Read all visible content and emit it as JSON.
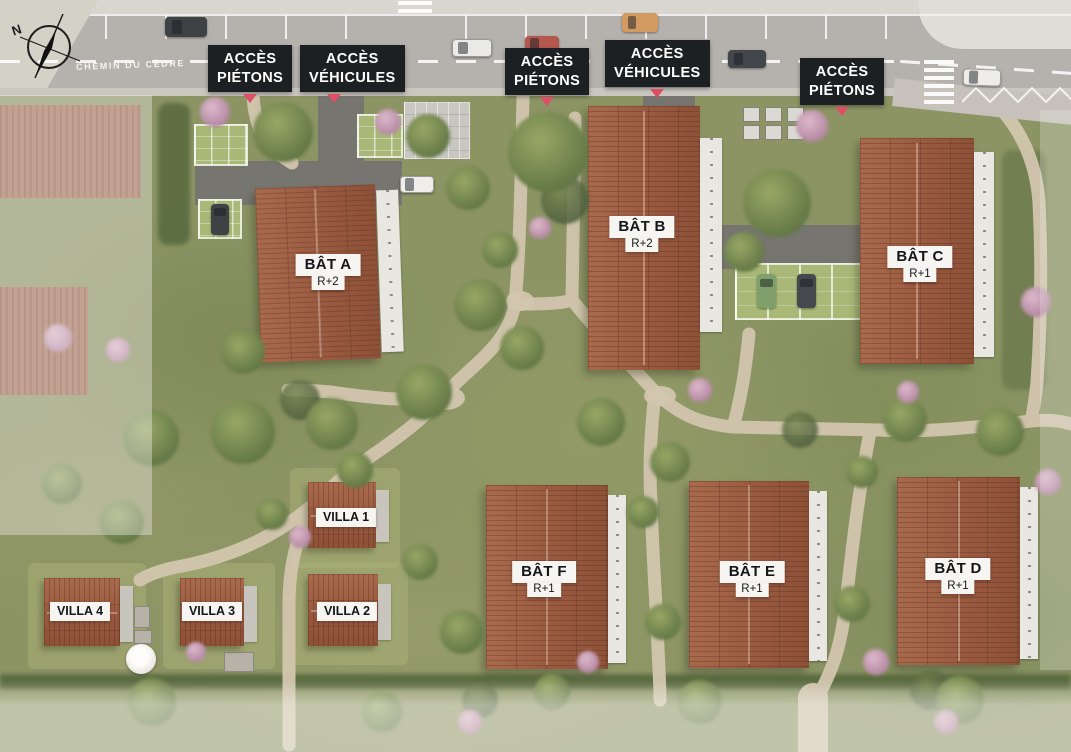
{
  "compass": {
    "label": "N"
  },
  "street": {
    "name": "CHEMIN DU CÈDRE"
  },
  "access_points": [
    {
      "line1": "ACCÈS",
      "line2": "PIÉTONS"
    },
    {
      "line1": "ACCÈS",
      "line2": "VÉHICULES"
    },
    {
      "line1": "ACCÈS",
      "line2": "PIÉTONS"
    },
    {
      "line1": "ACCÈS",
      "line2": "VÉHICULES"
    },
    {
      "line1": "ACCÈS",
      "line2": "PIÉTONS"
    }
  ],
  "buildings": [
    {
      "name": "BÂT A",
      "floors": "R+2"
    },
    {
      "name": "BÂT B",
      "floors": "R+2"
    },
    {
      "name": "BÂT C",
      "floors": "R+1"
    },
    {
      "name": "BÂT F",
      "floors": "R+1"
    },
    {
      "name": "BÂT E",
      "floors": "R+1"
    },
    {
      "name": "BÂT D",
      "floors": "R+1"
    }
  ],
  "villas": [
    {
      "name": "VILLA 1"
    },
    {
      "name": "VILLA 2"
    },
    {
      "name": "VILLA 3"
    },
    {
      "name": "VILLA 4"
    }
  ],
  "colors": {
    "access_label_bg": "#1d2023",
    "access_label_text": "#ffffff",
    "access_marker": "#dd4f66",
    "building_label_bg": "#f7f5f1",
    "building_label_text": "#15161a",
    "roof_terracotta": "#9a5a40",
    "grass": "#8c9464",
    "road": "#b5b1ac",
    "footpath": "#d2c6ae"
  }
}
